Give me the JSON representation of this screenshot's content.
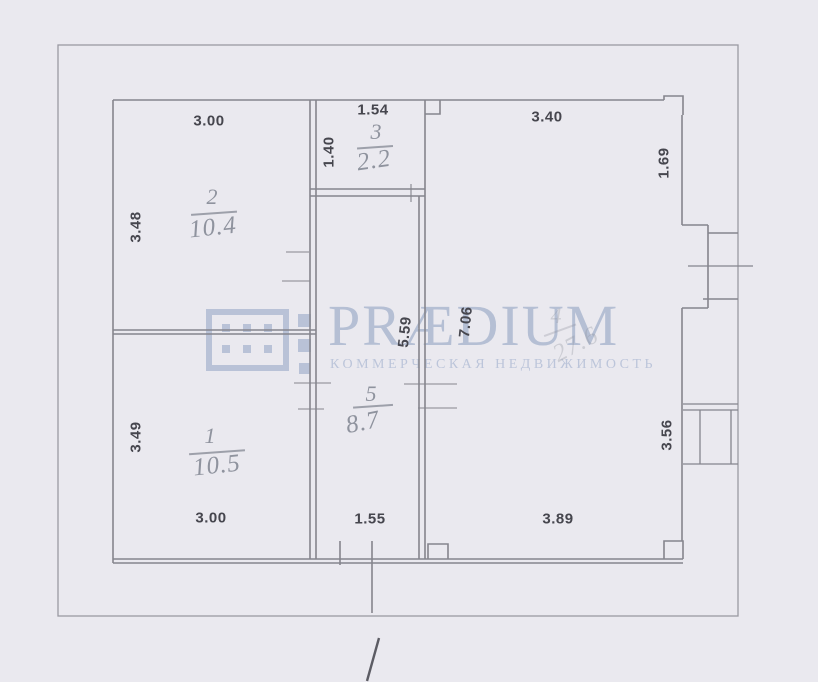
{
  "background_color": "#eae9ef",
  "watermark": {
    "wordmark": "PRÆDIUM",
    "subtitle": "КОММЕРЧЕСКАЯ НЕДВИЖИМОСТЬ",
    "color": "#b5bfd4",
    "logo": "window-grid-icon"
  },
  "plan": {
    "type": "floor-plan",
    "units": "m",
    "line_color": "#85858d",
    "dim_text_color": "#46464e",
    "room_label_color": "#8f939e",
    "rooms": [
      {
        "number": "1",
        "area": "10.5"
      },
      {
        "number": "2",
        "area": "10.4"
      },
      {
        "number": "3",
        "area": "2.2"
      },
      {
        "number": "4",
        "area": "27.6"
      },
      {
        "number": "5",
        "area": "8.7"
      }
    ],
    "dims": {
      "room2_top": "3.00",
      "room2_left": "3.48",
      "room3_top": "1.54",
      "room3_left": "1.40",
      "room4_top": "3.40",
      "room4_right_upper": "1.69",
      "room4_height": "7.06",
      "corridor_height": "5.59",
      "room4_right_lower": "3.56",
      "room1_left": "3.49",
      "room1_bottom": "3.00",
      "corridor_bottom": "1.55",
      "room4_bottom": "3.89"
    }
  }
}
